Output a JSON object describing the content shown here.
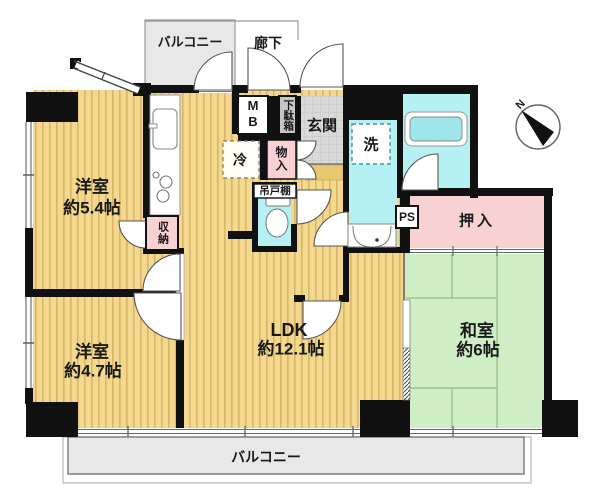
{
  "rooms": {
    "balcony_top": {
      "label": "バルコニー"
    },
    "corridor": {
      "label": "廊下"
    },
    "western1": {
      "name": "洋室",
      "size": "約5.4帖"
    },
    "western2": {
      "name": "洋室",
      "size": "約4.7帖"
    },
    "ldk": {
      "name": "LDK",
      "size": "約12.1帖"
    },
    "japanese": {
      "name": "和室",
      "size": "約6帖"
    },
    "entrance": {
      "label": "玄関"
    },
    "balcony_bottom": {
      "label": "バルコニー"
    }
  },
  "storage": {
    "oshiire": "押入",
    "shunou": "収納",
    "monoire": "物入",
    "getabako": "下駄箱",
    "tsuridodana": "吊戸棚"
  },
  "fixtures": {
    "mb": "MB",
    "ps": "PS",
    "fridge": "冷",
    "washer": "洗"
  },
  "compass": {
    "north": "N"
  },
  "colors": {
    "wall": "#111111",
    "floor_western": "#f3d88e",
    "floor_stripe": "#d8b76a",
    "floor_japanese": "#cfeec6",
    "tatami_line": "#8fbc82",
    "wet_area": "#b5f0f2",
    "closet_pink": "#f8d2d2",
    "balcony": "#e8e8e8",
    "entrance_tile": "#d9d9d9"
  }
}
